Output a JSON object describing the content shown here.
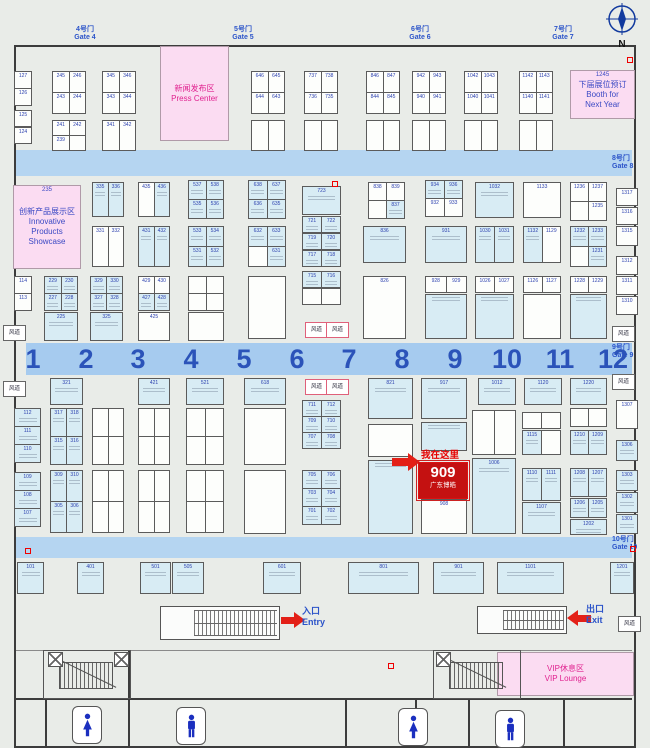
{
  "legend": {
    "filled_prefix": "*",
    "note": "booth numbers prefixed with * are drawn as occupied (cyan fill); empty string = unreadable/vacant booth"
  },
  "colors": {
    "bg": "#e9ece8",
    "aisle_band": "#b5d5f1",
    "aisle_number": "#2b53b9",
    "booth_fill": "#d8ecf4",
    "booth_number": "#2a3fae",
    "zone_pink": "#fbdcf2",
    "zone_magenta": "#e0218f",
    "zone_blue": "#3b49c4",
    "highlight_red": "#c41111",
    "gate_blue": "#2b53c9",
    "toilet_blue": "#1b2fbf"
  },
  "compass": {
    "label": "N"
  },
  "gates_top": [
    {
      "cn": "4号门",
      "en": "Gate 4",
      "x": 85
    },
    {
      "cn": "5号门",
      "en": "Gate 5",
      "x": 243
    },
    {
      "cn": "6号门",
      "en": "Gate 6",
      "x": 420
    },
    {
      "cn": "7号门",
      "en": "Gate 7",
      "x": 563
    }
  ],
  "gates_right": [
    {
      "cn": "8号门",
      "en": "Gate 8",
      "y": 155
    },
    {
      "cn": "9号门",
      "en": "Gate 9",
      "y": 344
    },
    {
      "cn": "10号门",
      "en": "Gate 10",
      "y": 536
    }
  ],
  "aisle_numbers": [
    "1",
    "2",
    "3",
    "4",
    "5",
    "6",
    "7",
    "8",
    "9",
    "10",
    "11",
    "12"
  ],
  "zones": [
    {
      "id": "press-center",
      "x": 160,
      "y": 46,
      "w": 67,
      "h": 93,
      "tag": "",
      "lines": [
        "新闻发布区",
        "Press Center"
      ],
      "style": "magenta"
    },
    {
      "id": "innovative-showcase",
      "x": 13,
      "y": 185,
      "w": 66,
      "h": 82,
      "tag": "235",
      "lines": [
        "创新产品展示区",
        "Innovative Products",
        "Showcase"
      ],
      "style": "blue"
    },
    {
      "id": "booth-next-year",
      "x": 570,
      "y": 70,
      "w": 63,
      "h": 47,
      "tag": "1245",
      "lines": [
        "下届展位预订",
        "Booth for",
        "Next Year"
      ],
      "style": "blue"
    },
    {
      "id": "vip-lounge",
      "x": 497,
      "y": 652,
      "w": 135,
      "h": 42,
      "tag": "",
      "lines": [
        "VIP休息区",
        "VIP Lounge"
      ],
      "style": "magenta"
    }
  ],
  "vents": {
    "label": "风道",
    "positions": [
      [
        3,
        325,
        0
      ],
      [
        3,
        381,
        0
      ],
      [
        305,
        322,
        1
      ],
      [
        326,
        322,
        1
      ],
      [
        305,
        379,
        1
      ],
      [
        326,
        379,
        1
      ],
      [
        612,
        326,
        0
      ],
      [
        612,
        374,
        0
      ],
      [
        618,
        616,
        0
      ]
    ]
  },
  "marker": {
    "text": "我在这里",
    "booth": "909",
    "company": "广东博皓"
  },
  "entry": {
    "cn": "入口",
    "en": "Entry"
  },
  "exit": {
    "cn": "出口",
    "en": "Exit"
  },
  "toilets": [
    {
      "type": "female",
      "x": 72,
      "y": 706
    },
    {
      "type": "male",
      "x": 176,
      "y": 707
    },
    {
      "type": "female",
      "x": 398,
      "y": 708
    },
    {
      "type": "male",
      "x": 495,
      "y": 710
    }
  ],
  "stairs": [
    [
      43,
      650,
      86,
      47
    ],
    [
      433,
      650,
      86,
      47
    ]
  ],
  "elevators": [
    [
      48,
      652
    ],
    [
      114,
      652
    ],
    [
      436,
      652
    ]
  ],
  "marks": [
    [
      332,
      181
    ],
    [
      25,
      548
    ],
    [
      630,
      546
    ],
    [
      388,
      663
    ],
    [
      627,
      57
    ]
  ],
  "blocks": [
    [
      14,
      71,
      17,
      34,
      [
        [
          "127"
        ],
        [
          "126"
        ]
      ]
    ],
    [
      14,
      110,
      17,
      16,
      [
        [
          "125"
        ]
      ]
    ],
    [
      14,
      127,
      17,
      16,
      [
        [
          "124"
        ]
      ]
    ],
    [
      52,
      71,
      33,
      42,
      [
        [
          "245",
          "246"
        ],
        [
          "243",
          "244"
        ]
      ]
    ],
    [
      102,
      71,
      33,
      42,
      [
        [
          "345",
          "346"
        ],
        [
          "343",
          "344"
        ]
      ]
    ],
    [
      251,
      71,
      33,
      42,
      [
        [
          "646",
          "645"
        ],
        [
          "644",
          "643"
        ]
      ]
    ],
    [
      304,
      71,
      33,
      42,
      [
        [
          "737",
          "738"
        ],
        [
          "736",
          "735"
        ]
      ]
    ],
    [
      366,
      71,
      33,
      42,
      [
        [
          "846",
          "847"
        ],
        [
          "844",
          "845"
        ]
      ]
    ],
    [
      412,
      71,
      33,
      42,
      [
        [
          "942",
          "943"
        ],
        [
          "940",
          "941"
        ]
      ]
    ],
    [
      464,
      71,
      33,
      42,
      [
        [
          "1042",
          "1043"
        ],
        [
          "1040",
          "1041"
        ]
      ]
    ],
    [
      519,
      71,
      33,
      42,
      [
        [
          "1142",
          "1143"
        ],
        [
          "1140",
          "1141"
        ]
      ]
    ],
    [
      52,
      120,
      33,
      30,
      [
        [
          "241",
          "242"
        ],
        [
          "239",
          ""
        ]
      ]
    ],
    [
      102,
      120,
      33,
      30,
      [
        [
          "341",
          "342"
        ]
      ]
    ],
    [
      251,
      120,
      33,
      30,
      [
        [
          "",
          ""
        ]
      ]
    ],
    [
      304,
      120,
      33,
      30,
      [
        [
          "",
          ""
        ]
      ]
    ],
    [
      366,
      120,
      33,
      30,
      [
        [
          "",
          ""
        ]
      ]
    ],
    [
      412,
      120,
      33,
      30,
      [
        [
          "",
          ""
        ]
      ]
    ],
    [
      464,
      120,
      33,
      30,
      [
        [
          "",
          ""
        ]
      ]
    ],
    [
      519,
      120,
      33,
      30,
      [
        [
          "",
          ""
        ]
      ]
    ],
    [
      14,
      276,
      17,
      34,
      [
        [
          "114"
        ],
        [
          "113"
        ]
      ]
    ],
    [
      92,
      182,
      31,
      34,
      [
        [
          "*335",
          "*336"
        ]
      ]
    ],
    [
      138,
      182,
      31,
      34,
      [
        [
          "435",
          "*436"
        ]
      ]
    ],
    [
      188,
      180,
      35,
      38,
      [
        [
          "*537",
          "*538"
        ],
        [
          "*535",
          "*536"
        ]
      ]
    ],
    [
      248,
      180,
      37,
      38,
      [
        [
          "*638",
          "*637"
        ],
        [
          "*636",
          "*635"
        ]
      ]
    ],
    [
      302,
      186,
      38,
      28,
      [
        [
          "*723"
        ]
      ]
    ],
    [
      302,
      216,
      38,
      16,
      [
        [
          "*721",
          "*722"
        ]
      ]
    ],
    [
      302,
      233,
      38,
      16,
      [
        [
          "*719",
          "*720"
        ]
      ]
    ],
    [
      302,
      250,
      38,
      16,
      [
        [
          "*717",
          "*718"
        ]
      ]
    ],
    [
      368,
      182,
      36,
      36,
      [
        [
          "838",
          "839"
        ],
        [
          "",
          "*837"
        ]
      ]
    ],
    [
      425,
      180,
      37,
      36,
      [
        [
          "*934",
          "*936"
        ],
        [
          "932",
          "933"
        ]
      ]
    ],
    [
      475,
      182,
      38,
      35,
      [
        [
          "*1032"
        ]
      ]
    ],
    [
      523,
      182,
      37,
      35,
      [
        [
          "1133"
        ]
      ]
    ],
    [
      570,
      182,
      36,
      38,
      [
        [
          "1236",
          "1237"
        ],
        [
          "",
          "1235"
        ]
      ]
    ],
    [
      616,
      188,
      21,
      17,
      [
        [
          "1317"
        ]
      ]
    ],
    [
      616,
      207,
      21,
      17,
      [
        [
          "1316"
        ]
      ]
    ],
    [
      616,
      226,
      21,
      19,
      [
        [
          "1315"
        ]
      ]
    ],
    [
      92,
      226,
      31,
      40,
      [
        [
          "331",
          "332"
        ]
      ]
    ],
    [
      138,
      226,
      31,
      40,
      [
        [
          "*431",
          "*432"
        ]
      ]
    ],
    [
      188,
      226,
      35,
      40,
      [
        [
          "*533",
          "*534"
        ],
        [
          "*531",
          "*532"
        ]
      ]
    ],
    [
      248,
      226,
      37,
      40,
      [
        [
          "*632",
          "*633"
        ],
        [
          "",
          "*631"
        ]
      ]
    ],
    [
      363,
      226,
      42,
      36,
      [
        [
          "*836"
        ]
      ]
    ],
    [
      425,
      226,
      41,
      36,
      [
        [
          "*931"
        ]
      ]
    ],
    [
      475,
      226,
      38,
      36,
      [
        [
          "*1030",
          "*1031"
        ]
      ]
    ],
    [
      523,
      226,
      37,
      36,
      [
        [
          "*1132",
          "1129"
        ]
      ]
    ],
    [
      570,
      226,
      36,
      40,
      [
        [
          "*1232",
          "*1233"
        ],
        [
          "",
          "*1231"
        ]
      ]
    ],
    [
      616,
      256,
      21,
      18,
      [
        [
          "1312"
        ]
      ]
    ],
    [
      616,
      276,
      21,
      18,
      [
        [
          "1311"
        ]
      ]
    ],
    [
      616,
      296,
      21,
      18,
      [
        [
          "1310"
        ]
      ]
    ],
    [
      44,
      276,
      33,
      34,
      [
        [
          "*229",
          "*230"
        ],
        [
          "*227",
          "*228"
        ]
      ]
    ],
    [
      44,
      312,
      33,
      28,
      [
        [
          "*225"
        ]
      ]
    ],
    [
      90,
      276,
      32,
      34,
      [
        [
          "*329",
          "*330"
        ],
        [
          "*327",
          "*328"
        ]
      ]
    ],
    [
      90,
      312,
      32,
      28,
      [
        [
          "*325"
        ]
      ]
    ],
    [
      138,
      276,
      31,
      34,
      [
        [
          "429",
          "430"
        ],
        [
          "*427",
          "*428"
        ]
      ]
    ],
    [
      138,
      312,
      31,
      28,
      [
        [
          "425"
        ]
      ]
    ],
    [
      188,
      276,
      35,
      34,
      [
        [
          "",
          ""
        ],
        [
          "",
          ""
        ]
      ]
    ],
    [
      188,
      312,
      35,
      28,
      [
        [
          ""
        ]
      ]
    ],
    [
      248,
      276,
      37,
      62,
      [
        [
          ""
        ]
      ]
    ],
    [
      302,
      271,
      38,
      16,
      [
        [
          "*715",
          "*716"
        ]
      ]
    ],
    [
      302,
      288,
      38,
      16,
      [
        [
          "",
          ""
        ]
      ]
    ],
    [
      363,
      276,
      42,
      62,
      [
        [
          "826"
        ]
      ]
    ],
    [
      425,
      276,
      41,
      16,
      [
        [
          "928",
          "929"
        ]
      ]
    ],
    [
      425,
      294,
      41,
      44,
      [
        [
          "*"
        ]
      ]
    ],
    [
      475,
      276,
      38,
      16,
      [
        [
          "1026",
          "1027"
        ]
      ]
    ],
    [
      475,
      294,
      38,
      44,
      [
        [
          "*"
        ]
      ]
    ],
    [
      523,
      276,
      37,
      16,
      [
        [
          "1126",
          "1127"
        ]
      ]
    ],
    [
      523,
      294,
      37,
      44,
      [
        [
          ""
        ]
      ]
    ],
    [
      570,
      276,
      36,
      16,
      [
        [
          "1228",
          "1229"
        ]
      ]
    ],
    [
      570,
      294,
      36,
      44,
      [
        [
          "*"
        ]
      ]
    ],
    [
      50,
      378,
      32,
      26,
      [
        [
          "*321"
        ]
      ]
    ],
    [
      138,
      378,
      31,
      26,
      [
        [
          "*421"
        ]
      ]
    ],
    [
      186,
      378,
      37,
      26,
      [
        [
          "*521"
        ]
      ]
    ],
    [
      244,
      378,
      41,
      26,
      [
        [
          "*618"
        ]
      ]
    ],
    [
      368,
      378,
      44,
      40,
      [
        [
          "*821"
        ]
      ]
    ],
    [
      421,
      378,
      45,
      40,
      [
        [
          "*917"
        ]
      ]
    ],
    [
      478,
      378,
      37,
      26,
      [
        [
          "*1012"
        ]
      ]
    ],
    [
      524,
      378,
      37,
      26,
      [
        [
          "*1120"
        ]
      ]
    ],
    [
      570,
      378,
      36,
      26,
      [
        [
          "*1220"
        ]
      ]
    ],
    [
      616,
      400,
      21,
      28,
      [
        [
          "1307"
        ]
      ]
    ],
    [
      14,
      408,
      26,
      54,
      [
        [
          "*112"
        ],
        [
          "*111"
        ],
        [
          "*110"
        ]
      ]
    ],
    [
      14,
      472,
      26,
      54,
      [
        [
          "*109"
        ],
        [
          "*108"
        ],
        [
          "*107"
        ]
      ]
    ],
    [
      50,
      408,
      32,
      56,
      [
        [
          "*317",
          "*318"
        ],
        [
          "*315",
          "*316"
        ]
      ]
    ],
    [
      50,
      470,
      32,
      62,
      [
        [
          "*309",
          "*310"
        ],
        [
          "*305",
          "*306"
        ]
      ]
    ],
    [
      92,
      408,
      31,
      56,
      [
        [
          "",
          ""
        ],
        [
          "",
          ""
        ]
      ]
    ],
    [
      92,
      470,
      31,
      62,
      [
        [
          "",
          ""
        ],
        [
          "",
          ""
        ]
      ]
    ],
    [
      138,
      408,
      31,
      56,
      [
        [
          "",
          ""
        ],
        [
          "",
          ""
        ]
      ]
    ],
    [
      138,
      470,
      31,
      62,
      [
        [
          "",
          ""
        ],
        [
          "",
          ""
        ]
      ]
    ],
    [
      186,
      408,
      37,
      56,
      [
        [
          "",
          ""
        ],
        [
          "",
          ""
        ]
      ]
    ],
    [
      186,
      470,
      37,
      62,
      [
        [
          "",
          ""
        ],
        [
          "",
          ""
        ]
      ]
    ],
    [
      244,
      408,
      41,
      56,
      [
        [
          ""
        ]
      ]
    ],
    [
      244,
      470,
      41,
      63,
      [
        [
          ""
        ]
      ]
    ],
    [
      302,
      400,
      38,
      48,
      [
        [
          "*711",
          "*712"
        ],
        [
          "*709",
          "*710"
        ],
        [
          "*707",
          "*708"
        ]
      ]
    ],
    [
      302,
      470,
      38,
      54,
      [
        [
          "*705",
          "*706"
        ],
        [
          "*703",
          "*704"
        ],
        [
          "*701",
          "*702"
        ]
      ]
    ],
    [
      368,
      424,
      44,
      32,
      [
        [
          ""
        ]
      ]
    ],
    [
      368,
      460,
      44,
      73,
      [
        [
          "*"
        ]
      ]
    ],
    [
      421,
      422,
      45,
      28,
      [
        [
          "*"
        ]
      ]
    ],
    [
      421,
      499,
      45,
      34,
      [
        [
          "908"
        ]
      ]
    ],
    [
      472,
      410,
      43,
      44,
      [
        [
          "",
          ""
        ]
      ]
    ],
    [
      472,
      458,
      43,
      75,
      [
        [
          "*1006"
        ]
      ]
    ],
    [
      522,
      412,
      38,
      16,
      [
        [
          "",
          ""
        ]
      ]
    ],
    [
      522,
      430,
      38,
      24,
      [
        [
          "*1115",
          ""
        ]
      ]
    ],
    [
      522,
      468,
      38,
      32,
      [
        [
          "*1110",
          "*1111"
        ]
      ]
    ],
    [
      522,
      502,
      38,
      31,
      [
        [
          "*1107"
        ]
      ]
    ],
    [
      570,
      408,
      36,
      18,
      [
        [
          "",
          ""
        ]
      ]
    ],
    [
      570,
      430,
      36,
      24,
      [
        [
          "*1210",
          "*1209"
        ]
      ]
    ],
    [
      570,
      468,
      36,
      28,
      [
        [
          "*1208",
          "*1207"
        ]
      ]
    ],
    [
      570,
      498,
      36,
      19,
      [
        [
          "*1206",
          "*1205"
        ]
      ]
    ],
    [
      570,
      519,
      36,
      15,
      [
        [
          "*1202"
        ]
      ]
    ],
    [
      616,
      440,
      21,
      20,
      [
        [
          "*1306"
        ]
      ]
    ],
    [
      616,
      470,
      21,
      20,
      [
        [
          "*1303"
        ]
      ]
    ],
    [
      616,
      492,
      21,
      20,
      [
        [
          "*1302"
        ]
      ]
    ],
    [
      616,
      514,
      21,
      19,
      [
        [
          "*1301"
        ]
      ]
    ],
    [
      17,
      562,
      26,
      31,
      [
        [
          "*101"
        ]
      ]
    ],
    [
      77,
      562,
      26,
      31,
      [
        [
          "*401"
        ]
      ]
    ],
    [
      140,
      562,
      30,
      31,
      [
        [
          "*501"
        ]
      ]
    ],
    [
      172,
      562,
      31,
      31,
      [
        [
          "*505"
        ]
      ]
    ],
    [
      263,
      562,
      37,
      31,
      [
        [
          "*601"
        ]
      ]
    ],
    [
      348,
      562,
      70,
      31,
      [
        [
          "*801"
        ]
      ]
    ],
    [
      433,
      562,
      50,
      31,
      [
        [
          "*901"
        ]
      ]
    ],
    [
      497,
      562,
      66,
      31,
      [
        [
          "*1101"
        ]
      ]
    ],
    [
      610,
      562,
      23,
      31,
      [
        [
          "*1201"
        ]
      ]
    ]
  ]
}
